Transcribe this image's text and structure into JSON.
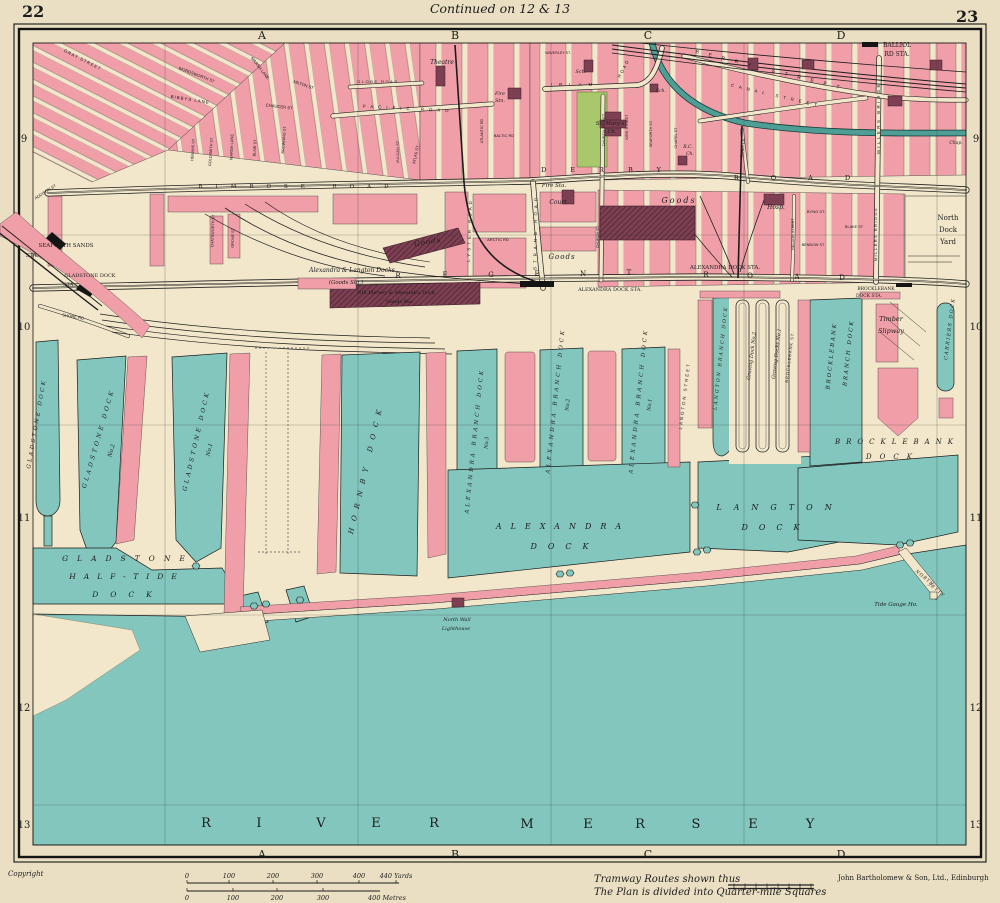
{
  "header": {
    "page_left": "22",
    "page_right": "23",
    "continued": "Continued on 12 & 13"
  },
  "footer": {
    "copyright": "Copyright",
    "tramway_note": "Tramway Routes shown thus",
    "plan_note": "The Plan is divided into Quarter-mile Squares",
    "publisher": "John Bartholomew & Son, Ltd., Edinburgh"
  },
  "colors": {
    "page": "#eadfc3",
    "land": "#f2e7cb",
    "water": "#83c6bd",
    "pink": "#f09fa9",
    "maroon": "#7d3f52",
    "green": "#a8c86b",
    "canal": "#4f9e96",
    "ink": "#1c1c1c"
  },
  "margins": {
    "columns": [
      {
        "t": "A",
        "x": 262
      },
      {
        "t": "B",
        "x": 455
      },
      {
        "t": "C",
        "x": 648
      },
      {
        "t": "D",
        "x": 841
      }
    ],
    "top_y": 39,
    "bottom_y": 858,
    "rows": [
      {
        "t": "9",
        "y": 142
      },
      {
        "t": "10",
        "y": 330
      },
      {
        "t": "11",
        "y": 521
      },
      {
        "t": "12",
        "y": 711
      },
      {
        "t": "13",
        "y": 828
      }
    ],
    "left_x": 24,
    "right_x": 976
  },
  "scale": {
    "yards": {
      "y_label": 878,
      "y_bar": 883,
      "ticks": [
        {
          "t": "0",
          "x": 187
        },
        {
          "t": "100",
          "x": 229
        },
        {
          "t": "200",
          "x": 273
        },
        {
          "t": "300",
          "x": 317
        },
        {
          "t": "400",
          "x": 359
        },
        {
          "t": "440 Yards",
          "x": 396
        }
      ],
      "x0": 187,
      "bar_end": 399
    },
    "metres": {
      "y_label": 900,
      "y_bar": 891,
      "ticks": [
        {
          "t": "0",
          "x": 187
        },
        {
          "t": "100",
          "x": 233
        },
        {
          "t": "200",
          "x": 277
        },
        {
          "t": "300",
          "x": 323
        },
        {
          "t": "400 Metres",
          "x": 387
        }
      ],
      "x0": 187,
      "bar_end": 380
    }
  },
  "labels": [
    {
      "t": "GRAY STREET",
      "x": 82,
      "y": 61,
      "r": 27,
      "s": 4.4,
      "sp": 1,
      "f": "sans"
    },
    {
      "t": "WORDSWORTH ST",
      "x": 196,
      "y": 76,
      "r": 21,
      "s": 4.2,
      "f": "sans"
    },
    {
      "t": "BIBBYS LANE",
      "x": 190,
      "y": 101,
      "r": 9,
      "s": 4.4,
      "sp": 1,
      "f": "sans"
    },
    {
      "t": "MARSH LANE",
      "x": 259,
      "y": 69,
      "r": 52,
      "s": 4.2,
      "f": "sans"
    },
    {
      "t": "MARSH LANE",
      "x": 233,
      "y": 147,
      "r": -88,
      "s": 4,
      "f": "sans"
    },
    {
      "t": "CHAUCER ST",
      "x": 279,
      "y": 108,
      "r": 7,
      "s": 4.2,
      "f": "sans"
    },
    {
      "t": "MILTON ST",
      "x": 303,
      "y": 86,
      "r": 19,
      "s": 4,
      "f": "sans"
    },
    {
      "t": "GOLDSMITH ST",
      "x": 212,
      "y": 152,
      "r": -86,
      "s": 3.8,
      "f": "sans"
    },
    {
      "t": "HEMANS ST",
      "x": 194,
      "y": 150,
      "r": -86,
      "s": 3.8,
      "f": "sans"
    },
    {
      "t": "BLAIR ST",
      "x": 256,
      "y": 148,
      "r": -86,
      "s": 3.8,
      "f": "sans"
    },
    {
      "t": "BROWNING ST",
      "x": 285,
      "y": 140,
      "r": -86,
      "s": 3.8,
      "f": "sans"
    },
    {
      "t": "CHATSWORTH ST",
      "x": 214,
      "y": 231,
      "r": -88,
      "s": 3.8,
      "f": "sans"
    },
    {
      "t": "GROVE ST",
      "x": 234,
      "y": 238,
      "r": -88,
      "s": 3.8,
      "f": "sans"
    },
    {
      "t": "ADDISON ST",
      "x": 46,
      "y": 193,
      "r": -33,
      "s": 4,
      "f": "sans"
    },
    {
      "t": "SHORE RD",
      "x": 73,
      "y": 318,
      "r": 9,
      "s": 4.2,
      "f": "sans"
    },
    {
      "t": "GLOBE ROAD",
      "x": 378,
      "y": 83,
      "s": 4,
      "sp": 1.5,
      "f": "sans"
    },
    {
      "t": "PACIFIC ROAD",
      "x": 408,
      "y": 110,
      "r": 3,
      "s": 4.4,
      "sp": 5,
      "f": "sans"
    },
    {
      "t": "VULCAN ST",
      "x": 399,
      "y": 152,
      "r": -90,
      "s": 4,
      "f": "sans"
    },
    {
      "t": "ATLAS ST",
      "x": 417,
      "y": 155,
      "r": -78,
      "s": 4,
      "f": "sans"
    },
    {
      "t": "ATLANTIC RD",
      "x": 483,
      "y": 131,
      "r": -90,
      "s": 3.8,
      "f": "sans"
    },
    {
      "t": "BALTIC RD",
      "x": 504,
      "y": 137,
      "s": 4,
      "f": "sans"
    },
    {
      "t": "LYSTER ROAD",
      "x": 471,
      "y": 230,
      "r": -88,
      "s": 4.4,
      "sp": 3,
      "f": "sans"
    },
    {
      "t": "ARCTIC RD",
      "x": 498,
      "y": 241,
      "s": 4,
      "f": "sans"
    },
    {
      "t": "STRAND ROAD",
      "x": 537,
      "y": 232,
      "r": -89,
      "s": 4.4,
      "sp": 4,
      "f": "sans"
    },
    {
      "t": "IRLAM",
      "x": 575,
      "y": 86,
      "s": 4.4,
      "sp": 7,
      "f": "sans"
    },
    {
      "t": "ROAD",
      "x": 625,
      "y": 69,
      "r": -62,
      "s": 4.4,
      "sp": 2,
      "f": "sans"
    },
    {
      "t": "WAVERLEY ST.",
      "x": 558,
      "y": 54,
      "s": 3.6,
      "f": "sans"
    },
    {
      "t": "CHURCH STREET",
      "x": 605,
      "y": 130,
      "r": -90,
      "s": 3.8,
      "f": "sans"
    },
    {
      "t": "CHURCH ST",
      "x": 599,
      "y": 237,
      "r": -90,
      "s": 3.8,
      "f": "sans"
    },
    {
      "t": "KIRK STREET",
      "x": 628,
      "y": 127,
      "r": -90,
      "s": 3.8,
      "f": "sans"
    },
    {
      "t": "SEAFORTH ST",
      "x": 652,
      "y": 134,
      "r": -90,
      "s": 3.8,
      "f": "sans"
    },
    {
      "t": "CHAPEL ST",
      "x": 677,
      "y": 138,
      "r": -90,
      "s": 3.8,
      "f": "sans"
    },
    {
      "t": "SANDY LA.",
      "x": 744,
      "y": 148,
      "r": -82,
      "s": 3.8,
      "f": "sans"
    },
    {
      "t": "BERRY STREET",
      "x": 772,
      "y": 72,
      "r": 14,
      "s": 5,
      "sp": 10,
      "f": "sans"
    },
    {
      "t": "CANAL STREET",
      "x": 776,
      "y": 97,
      "r": 13,
      "s": 4.4,
      "sp": 5,
      "f": "sans"
    },
    {
      "t": "MILLERS BRIDGE",
      "x": 880,
      "y": 118,
      "r": -90,
      "s": 4.4,
      "sp": 2.5,
      "f": "sans"
    },
    {
      "t": "MILLERS BRIDGE",
      "x": 877,
      "y": 234,
      "r": -90,
      "s": 4,
      "sp": 1.5,
      "f": "sans"
    },
    {
      "t": "NELSON STREET",
      "x": 794,
      "y": 234,
      "r": -90,
      "s": 3.8,
      "f": "sans"
    },
    {
      "t": "BYNG ST.",
      "x": 816,
      "y": 213,
      "s": 4,
      "f": "sans"
    },
    {
      "t": "BLAKE ST",
      "x": 854,
      "y": 228,
      "s": 3.8,
      "f": "sans"
    },
    {
      "t": "BENBOW ST",
      "x": 813,
      "y": 246,
      "s": 3.8,
      "f": "sans"
    },
    {
      "t": "LANGTON STREET",
      "x": 686,
      "y": 396,
      "r": -83,
      "s": 4.4,
      "sp": 2,
      "f": "sans"
    },
    {
      "t": "BROCKLEBANK ST.",
      "x": 791,
      "y": 357,
      "r": -83,
      "s": 4,
      "sp": 1,
      "f": "sans"
    },
    {
      "t": "RIMROSE ROAD",
      "x": 300,
      "y": 188,
      "s": 5.5,
      "sp": 13
    },
    {
      "t": "DERBY",
      "x": 613,
      "y": 172,
      "s": 6.5,
      "sp": 24
    },
    {
      "t": "ROAD",
      "x": 808,
      "y": 180,
      "s": 6.5,
      "sp": 32
    },
    {
      "t": "R",
      "x": 398,
      "y": 278,
      "s": 7
    },
    {
      "t": "E",
      "x": 445,
      "y": 277,
      "s": 7
    },
    {
      "t": "G",
      "x": 491,
      "y": 277,
      "s": 7
    },
    {
      "t": "E",
      "x": 537,
      "y": 276,
      "s": 7
    },
    {
      "t": "N",
      "x": 583,
      "y": 276,
      "s": 7
    },
    {
      "t": "T",
      "x": 629,
      "y": 275,
      "s": 7
    },
    {
      "t": "R",
      "x": 706,
      "y": 277,
      "s": 7
    },
    {
      "t": "O",
      "x": 750,
      "y": 278,
      "s": 7
    },
    {
      "t": "A",
      "x": 797,
      "y": 279,
      "s": 7
    },
    {
      "t": "D",
      "x": 842,
      "y": 280,
      "s": 7
    },
    {
      "t": "BALLIOL",
      "x": 897,
      "y": 47,
      "s": 6
    },
    {
      "t": "RD STA.",
      "x": 897,
      "y": 56,
      "s": 6
    },
    {
      "t": "ALEXANDRA DOCK STA.",
      "x": 725,
      "y": 269,
      "s": 5.5
    },
    {
      "t": "ALEXANDRA DOCK STA.",
      "x": 610,
      "y": 291,
      "s": 5
    },
    {
      "t": "BROCKLEBANK",
      "x": 876,
      "y": 290,
      "s": 4.5
    },
    {
      "t": "DOCK STA.",
      "x": 869,
      "y": 297,
      "s": 4.5
    },
    {
      "t": "SEAFORTH SANDS",
      "x": 66,
      "y": 247,
      "s": 5.5
    },
    {
      "t": "STA.",
      "x": 32,
      "y": 257,
      "s": 5.5
    },
    {
      "t": "GLADSTONE DOCK",
      "x": 90,
      "y": 277,
      "s": 5
    },
    {
      "t": "STA.",
      "x": 69,
      "y": 286,
      "s": 5
    },
    {
      "t": "North",
      "x": 948,
      "y": 220,
      "s": 7
    },
    {
      "t": "Dock",
      "x": 948,
      "y": 232,
      "s": 7
    },
    {
      "t": "Yard",
      "x": 948,
      "y": 244,
      "s": 7
    },
    {
      "t": "Theatre",
      "x": 442,
      "y": 64,
      "s": 6,
      "i": 1
    },
    {
      "t": "Fire",
      "x": 500,
      "y": 95,
      "s": 4.8,
      "i": 1
    },
    {
      "t": "Stn.",
      "x": 500,
      "y": 102,
      "s": 4.8,
      "i": 1
    },
    {
      "t": "Sch.",
      "x": 581,
      "y": 73,
      "s": 5,
      "i": 1
    },
    {
      "t": "Sch.",
      "x": 661,
      "y": 92,
      "s": 4.5,
      "i": 1
    },
    {
      "t": "St. Mary's",
      "x": 610,
      "y": 125,
      "s": 5.5,
      "i": 1
    },
    {
      "t": "Ch.",
      "x": 612,
      "y": 133,
      "s": 5,
      "i": 1
    },
    {
      "t": "R.C.",
      "x": 688,
      "y": 148,
      "s": 4.5,
      "i": 1
    },
    {
      "t": "Ch.",
      "x": 690,
      "y": 155,
      "s": 4.5,
      "i": 1
    },
    {
      "t": "Fire Sta.",
      "x": 554,
      "y": 187,
      "s": 5.5,
      "i": 1
    },
    {
      "t": "Court",
      "x": 558,
      "y": 204,
      "s": 6,
      "i": 1
    },
    {
      "t": "Goods",
      "x": 428,
      "y": 244,
      "r": -10,
      "s": 7,
      "sp": 1,
      "i": 1
    },
    {
      "t": "Goods",
      "x": 562,
      "y": 259,
      "s": 7,
      "sp": 1,
      "i": 1
    },
    {
      "t": "Goods",
      "x": 679,
      "y": 203,
      "s": 8,
      "sp": 2,
      "i": 1
    },
    {
      "t": "Hosp.",
      "x": 776,
      "y": 209,
      "s": 6,
      "i": 1
    },
    {
      "t": "Chap.",
      "x": 956,
      "y": 144,
      "s": 4.5,
      "i": 1
    },
    {
      "t": "Alexandra & Langton Docks",
      "x": 352,
      "y": 272,
      "s": 6,
      "i": 1
    },
    {
      "t": "(Goods Sta.)",
      "x": 346,
      "y": 284,
      "s": 5.5,
      "i": 1
    },
    {
      "t": "Nth Mersey & Alexandra Dock",
      "x": 396,
      "y": 294,
      "s": 5
    },
    {
      "t": "Goods Sta.",
      "x": 400,
      "y": 303,
      "s": 5
    },
    {
      "t": "Timber",
      "x": 891,
      "y": 321,
      "s": 6.5,
      "i": 1
    },
    {
      "t": "Slipway",
      "x": 891,
      "y": 333,
      "s": 6.5,
      "i": 1
    },
    {
      "t": "North Wall",
      "x": 457,
      "y": 621,
      "s": 5,
      "i": 1
    },
    {
      "t": "Lighthouse",
      "x": 456,
      "y": 630,
      "s": 5,
      "i": 1
    },
    {
      "t": "Tide Gauge Ho.",
      "x": 896,
      "y": 606,
      "s": 5.5,
      "i": 1
    },
    {
      "t": "Graving Dock No.2",
      "x": 753,
      "y": 356,
      "r": -83,
      "s": 5,
      "i": 1
    },
    {
      "t": "Graving Docks No.1",
      "x": 778,
      "y": 354,
      "r": -83,
      "s": 5,
      "i": 1
    },
    {
      "t": "GLADSTONE DOCK",
      "x": 38,
      "y": 424,
      "r": -80,
      "s": 5.5,
      "sp": 2.5,
      "i": 1
    },
    {
      "t": "GLADSTONE DOCK",
      "x": 100,
      "y": 439,
      "r": -74,
      "s": 6,
      "sp": 3,
      "i": 1
    },
    {
      "t": "No.2",
      "x": 113,
      "y": 451,
      "r": -74,
      "s": 5.5,
      "i": 1
    },
    {
      "t": "GLADSTONE DOCK",
      "x": 198,
      "y": 441,
      "r": -77,
      "s": 6,
      "sp": 3,
      "i": 1
    },
    {
      "t": "No.1",
      "x": 211,
      "y": 450,
      "r": -77,
      "s": 5.5,
      "i": 1
    },
    {
      "t": "HORNBY DOCK",
      "x": 368,
      "y": 469,
      "r": -77,
      "s": 7,
      "sp": 7,
      "i": 1
    },
    {
      "t": "GLADSTONE",
      "x": 128,
      "y": 561,
      "s": 7.5,
      "sp": 9,
      "i": 1
    },
    {
      "t": "HALF-TIDE",
      "x": 127,
      "y": 579,
      "s": 7.5,
      "sp": 8,
      "i": 1
    },
    {
      "t": "DOCK",
      "x": 128,
      "y": 597,
      "s": 7.5,
      "sp": 12,
      "i": 1
    },
    {
      "t": "ALEXANDRA BRANCH DOCK",
      "x": 476,
      "y": 441,
      "r": -84,
      "s": 5.5,
      "sp": 3,
      "i": 1
    },
    {
      "t": "No.3",
      "x": 488,
      "y": 443,
      "r": -84,
      "s": 5,
      "i": 1
    },
    {
      "t": "ALEXANDRA BRANCH DOCK",
      "x": 557,
      "y": 401,
      "r": -84,
      "s": 5.5,
      "sp": 3,
      "i": 1
    },
    {
      "t": "No.2",
      "x": 569,
      "y": 405,
      "r": -84,
      "s": 5,
      "i": 1
    },
    {
      "t": "ALEXANDRA BRANCH DOCK",
      "x": 640,
      "y": 401,
      "r": -84,
      "s": 5.5,
      "sp": 3,
      "i": 1
    },
    {
      "t": "No.1",
      "x": 651,
      "y": 405,
      "r": -84,
      "s": 5,
      "i": 1
    },
    {
      "t": "LANGTON BRANCH DOCK",
      "x": 722,
      "y": 358,
      "r": -84,
      "s": 4.8,
      "sp": 2,
      "i": 1
    },
    {
      "t": "BROCKLEBANK",
      "x": 833,
      "y": 356,
      "r": -84,
      "s": 5.5,
      "sp": 2,
      "i": 1
    },
    {
      "t": "BRANCH DOCK",
      "x": 850,
      "y": 353,
      "r": -84,
      "s": 5.5,
      "sp": 2,
      "i": 1
    },
    {
      "t": "CARRIERS DOCK",
      "x": 951,
      "y": 329,
      "r": -83,
      "s": 4.8,
      "sp": 1.5,
      "i": 1
    },
    {
      "t": "BROCKLEBANK",
      "x": 897,
      "y": 444,
      "s": 7,
      "sp": 6,
      "i": 1
    },
    {
      "t": "DOCK",
      "x": 893,
      "y": 459,
      "s": 7,
      "sp": 8,
      "i": 1
    },
    {
      "t": "ALEXANDRA",
      "x": 563,
      "y": 529,
      "s": 8,
      "sp": 9,
      "i": 1
    },
    {
      "t": "DOCK",
      "x": 565,
      "y": 549,
      "s": 8,
      "sp": 11,
      "i": 1
    },
    {
      "t": "LANGTON",
      "x": 780,
      "y": 510,
      "s": 8,
      "sp": 12,
      "i": 1
    },
    {
      "t": "DOCK",
      "x": 776,
      "y": 530,
      "s": 8,
      "sp": 11,
      "i": 1
    },
    {
      "t": "NORTH",
      "x": 924,
      "y": 579,
      "r": 40,
      "s": 4.5,
      "sp": 1,
      "i": 1
    },
    {
      "t": "JETTY",
      "x": 936,
      "y": 591,
      "r": 40,
      "s": 4.5,
      "sp": 1,
      "i": 1
    },
    {
      "t": "R",
      "x": 206,
      "y": 827,
      "s": 13
    },
    {
      "t": "I",
      "x": 259,
      "y": 827,
      "s": 13
    },
    {
      "t": "V",
      "x": 321,
      "y": 827,
      "s": 13
    },
    {
      "t": "E",
      "x": 376,
      "y": 827,
      "s": 13
    },
    {
      "t": "R",
      "x": 434,
      "y": 827,
      "s": 13
    },
    {
      "t": "M",
      "x": 527,
      "y": 828,
      "s": 13
    },
    {
      "t": "E",
      "x": 588,
      "y": 828,
      "s": 13
    },
    {
      "t": "R",
      "x": 640,
      "y": 828,
      "s": 13
    },
    {
      "t": "S",
      "x": 696,
      "y": 828,
      "s": 13
    },
    {
      "t": "E",
      "x": 753,
      "y": 828,
      "s": 13
    },
    {
      "t": "Y",
      "x": 810,
      "y": 828,
      "s": 13
    }
  ]
}
